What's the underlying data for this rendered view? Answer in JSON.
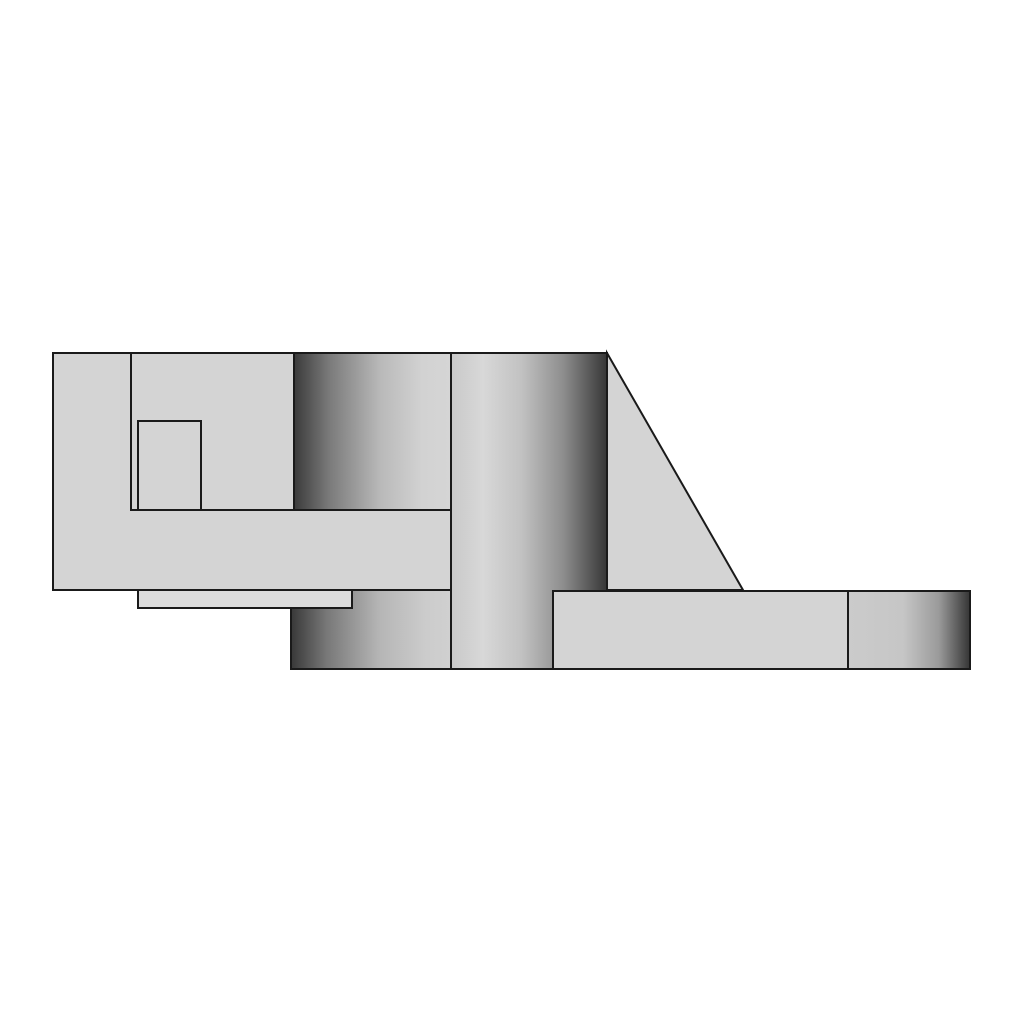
{
  "scene": {
    "description": "3D CAD shaded side view of a flanged bracket: left block with pocket, boss cylinder, center column cylinder, triangular gusset rib, step ledge, hub flange and base plate with rounded end",
    "canvas": {
      "width": 1024,
      "height": 1024
    },
    "colors": {
      "background": "#ffffff",
      "edge": "#1a1a1a",
      "face": "#d4d4d4",
      "step_face": "#dcdcdc"
    }
  },
  "gradients": {
    "boss_cylinder": {
      "dir": "to right",
      "stops": [
        "#3c3c3c 0%",
        "#7a7a7a 22%",
        "#b9b9b9 55%",
        "#d2d2d2 82%",
        "#d5d5d5 100%"
      ]
    },
    "hub_flange": {
      "dir": "to right",
      "stops": [
        "#3a3a3a 0%",
        "#787878 22%",
        "#b5b5b5 55%",
        "#cccccc 85%",
        "#d0d0d0 100%"
      ]
    },
    "center_column": {
      "dir": "to right",
      "stops": [
        "#c9c9c9 0%",
        "#d8d8d8 20%",
        "#c2c2c2 45%",
        "#8e8e8e 72%",
        "#383838 100%"
      ]
    },
    "base_plate_end": {
      "dir": "to right",
      "stops": [
        "#cbcbcb 0%",
        "#c6c6c6 45%",
        "#9a9a9a 75%",
        "#383838 100%"
      ]
    }
  },
  "parts": {
    "left_block": "left block face",
    "boss_cylinder": "boss cylinder face",
    "inner_edge_vertical": "inner vertical edge",
    "inner_edge_horizontal": "inner horizontal edge",
    "pocket": "pocket outline",
    "center_column": "center column cylinder face",
    "gusset": "gusset rib triangle",
    "hub_flange": "hub flange bottom face",
    "step_ledge": "step ledge face",
    "base_plate": "base plate face",
    "base_plate_end": "base plate rounded end face"
  }
}
